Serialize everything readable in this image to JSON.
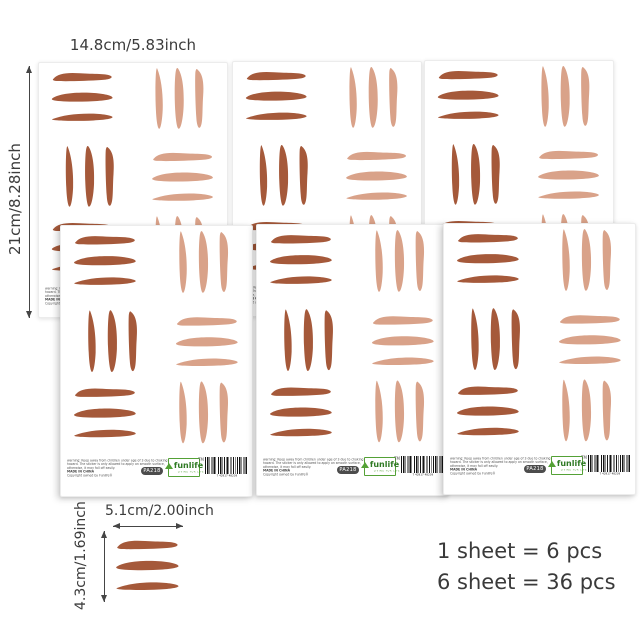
{
  "annotations": {
    "sheet_width": "14.8cm/5.83inch",
    "sheet_height": "21cm/8.28inch",
    "sticker_width": "5.1cm/2.00inch",
    "sticker_height": "4.3cm/1.69inch"
  },
  "info": {
    "line1": "1 sheet = 6 pcs",
    "line2": "6 sheet = 36 pcs"
  },
  "sheet": {
    "code": "PA218",
    "brand": "funlife",
    "brand_tm": "TM",
    "brand_tagline": "LIVING FOR LIFE",
    "barcode_digits": "7 42917 48239",
    "warning_line1": "warning: Keep away from children under age of 3 due to choking",
    "warning_line2": "hazard. The sticker is only allowed to apply on smooth surface,",
    "warning_line3": "otherwise, it may fall off easily.",
    "warning_line4": "MADE IN CHINA",
    "warning_line5": "Copyright owned by Funlife®"
  },
  "colors": {
    "stroke_dark": "#a5593a",
    "stroke_light": "#d9a289",
    "brand_green": "#54a136"
  }
}
